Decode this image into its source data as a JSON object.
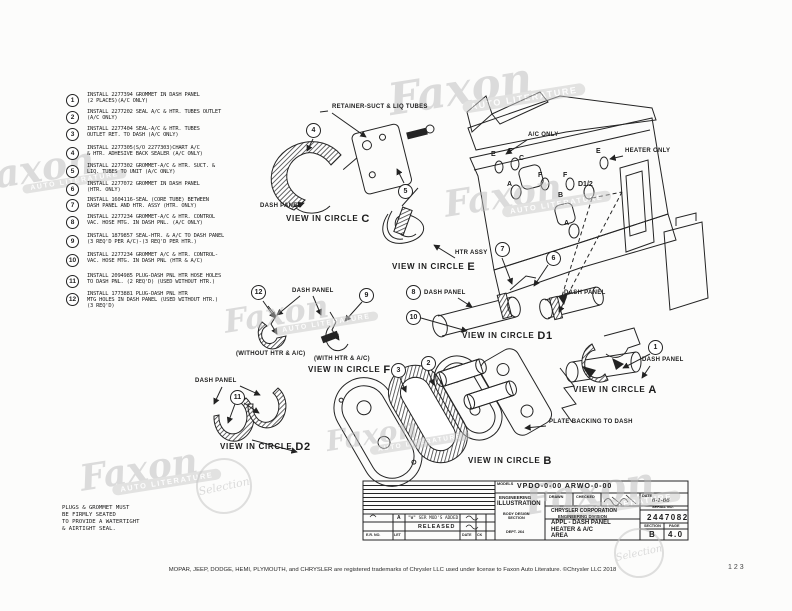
{
  "watermark": {
    "brand": "Faxon",
    "sub": "AUTO LITERATURE",
    "stamp": "Selection"
  },
  "parts_list": [
    {
      "num": "1",
      "text": "INSTALL 2277394 GROMMET IN DASH PANEL\n(2 PLACES)(A/C ONLY)"
    },
    {
      "num": "2",
      "text": "INSTALL 2277202 SEAL A/C & HTR. TUBES OUTLET\n(A/C ONLY)"
    },
    {
      "num": "3",
      "text": "INSTALL 2277404 SEAL-A/C & HTR. TUBES\nOUTLET RET. TO DASH (A/C ONLY)"
    },
    {
      "num": "4",
      "text": "INSTALL 2277305(S/O 2277303)CHART A/C\n& HTR. ADHESIVE BACK SEALER (A/C ONLY)"
    },
    {
      "num": "5",
      "text": "INSTALL 2277302 GROMMET-A/C & HTR. SUCT. &\nLIQ. TUBES TO UNIT (A/C ONLY)"
    },
    {
      "num": "6",
      "text": "INSTALL 2277072 GROMMET IN DASH PANEL\n(HTR. ONLY)"
    },
    {
      "num": "7",
      "text": "INSTALL 1604116-SEAL (CORE TUBE) BETWEEN\nDASH PANEL AND HTR. ASSY (HTR. ONLY)"
    },
    {
      "num": "8",
      "text": "INSTALL 2277234 GROMMET-A/C & HTR. CONTROL\nVAC. HOSE MTG. IN DASH PNL. (A/C ONLY)"
    },
    {
      "num": "9",
      "text": "INSTALL 1879857 SEAL-HTR. & A/C TO DASH PANEL\n(3 REQ'D PER A/C)-(3 REQ'D PER HTR.)"
    },
    {
      "num": "10",
      "text": "INSTALL 2277234 GROMMET A/C & HTR. CONTROL-\nVAC. HOSE MTG. IN DASH PNL (HTR & A/C)"
    },
    {
      "num": "11",
      "text": "INSTALL 2094985 PLUG-DASH PNL HTR HOSE HOLES\nTO DASH PNL. (2 REQ'D) (USED WITHOUT HTR.)"
    },
    {
      "num": "12",
      "text": "INSTALL 1773881 PLUG-DASH PNL HTR\nMTG HOLES IN DASH PANEL (USED WITHOUT HTR.)\n(3 REQ'D)"
    }
  ],
  "labels": {
    "retainer": "RETAINER-SUCT & LIQ TUBES",
    "dash_panel": "DASH PANEL",
    "ac_only": "A/C ONLY",
    "heater_only": "HEATER ONLY",
    "htr_assy": "HTR ASSY",
    "plate_backing": "PLATE BACKING TO DASH",
    "without_htr": "(WITHOUT HTR & A/C)",
    "with_htr": "(WITH HTR & A/C)"
  },
  "views": {
    "prefix": "VIEW IN CIRCLE",
    "c": "C",
    "e": "E",
    "d1": "D1",
    "f": "F",
    "d2": "D2",
    "a": "A",
    "b": "B"
  },
  "overview_letters": {
    "e1": "E",
    "f1": "F",
    "c": "C",
    "f2": "F",
    "a1": "A",
    "f3": "F",
    "d12": "D1/2",
    "b": "B",
    "a2": "A",
    "e2": "E"
  },
  "note": "PLUGS & GROMMET MUST\nBE FIRMLY SEATED\nTO PROVIDE A WATERTIGHT\n& AIRTIGHT SEAL.",
  "title_block": {
    "models_label": "MODELS",
    "models": "VPDO-0-00   ARWO-0-00",
    "eng": "ENGINEERING",
    "ill": "ILLUSTRATION",
    "body": "BODY DESIGN\nSECTION",
    "dept": "DEPT. 264",
    "drawn_label": "DRAWN",
    "checked_label": "CHECKED",
    "company": "CHRYSLER CORPORATION",
    "division": "ENGINEERING DIVISION",
    "date_label": "DATE",
    "date": "6-1-66",
    "serial_label": "SERIAL NO.",
    "serial": "2447082",
    "appl": "APPL - DASH PANEL\nHEATER & A/C\nAREA",
    "section_label": "SECTION",
    "section": "B",
    "page_label": "PAGE",
    "page": "4.0",
    "rev_a_letter": "A",
    "rev_a_text": "\"W\" SER MOD'S ADDED",
    "released": "RELEASED",
    "er_label": "E.R. NO.",
    "let_label": "LET",
    "rev_date_label": "DATE",
    "ck_label": "CK"
  },
  "footer": {
    "trademark": "MOPAR, JEEP, DODGE, HEMI, PLYMOUTH, and CHRYSLER are registered trademarks of Chrysler LLC used under license to Faxon Auto Literature. ©Chrysler LLC 2018",
    "page_number": "123"
  }
}
